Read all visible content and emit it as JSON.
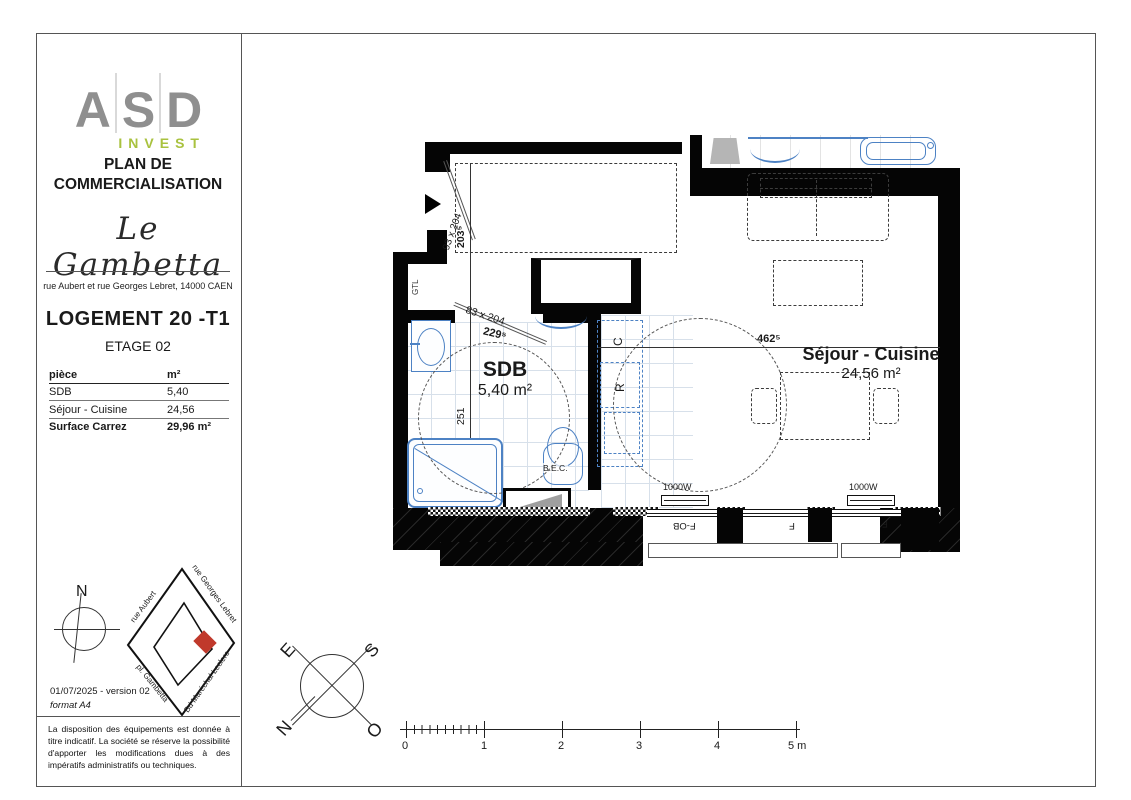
{
  "panel": {
    "logo": {
      "letters": [
        "A",
        "S",
        "D"
      ],
      "sub": "INVEST"
    },
    "title": "PLAN DE COMMERCIALISATION",
    "project": "Le Gambetta",
    "address": "rue Aubert et rue Georges Lebret, 14000 CAEN",
    "unit": "LOGEMENT 20 -T1",
    "floor": "ETAGE 02",
    "table": {
      "headers": [
        "pièce",
        "m²"
      ],
      "rows": [
        {
          "name": "SDB",
          "area": "5,40"
        },
        {
          "name": "Séjour - Cuisine",
          "area": "24,56"
        }
      ],
      "total": {
        "name": "Surface Carrez",
        "area": "29,96 m²"
      }
    },
    "north_letter": "N",
    "sitemap": {
      "streets": [
        "rue Aubert",
        "rue Georges Lebret",
        "pl. Gambetta",
        "Bd Maréchal Leclerc"
      ]
    },
    "version": "01/07/2025 - version 02",
    "format": "format A4",
    "disclaimer": "La disposition des équipements est donnée à titre indicatif. La société se réserve la possibilité d'apporter les modifications dues à des impératifs administratifs ou techniques."
  },
  "plan": {
    "rooms": [
      {
        "name": "SDB",
        "area": "5,40 m²"
      },
      {
        "name": "Séjour - Cuisine",
        "area": "24,56 m²"
      }
    ],
    "dims": {
      "entry_door": "93 x 204",
      "entry_depth": "203⁵",
      "sdb_door": "83 x 204",
      "sdb_door_width": "229⁵",
      "sdb_width": "251",
      "sejour_width": "462⁵"
    },
    "labels": {
      "gtl": "GTL",
      "bec": "B.E.C.",
      "kitchen_c": "C",
      "kitchen_r": "R"
    },
    "radiators": [
      "1000W",
      "1000W"
    ],
    "windows": [
      "F-OB",
      "F",
      "F"
    ]
  },
  "compass": {
    "letters": [
      "E",
      "S",
      "N",
      "O"
    ]
  },
  "scale": {
    "ticks": [
      "0",
      "1",
      "2",
      "3",
      "4",
      "5 m"
    ]
  }
}
